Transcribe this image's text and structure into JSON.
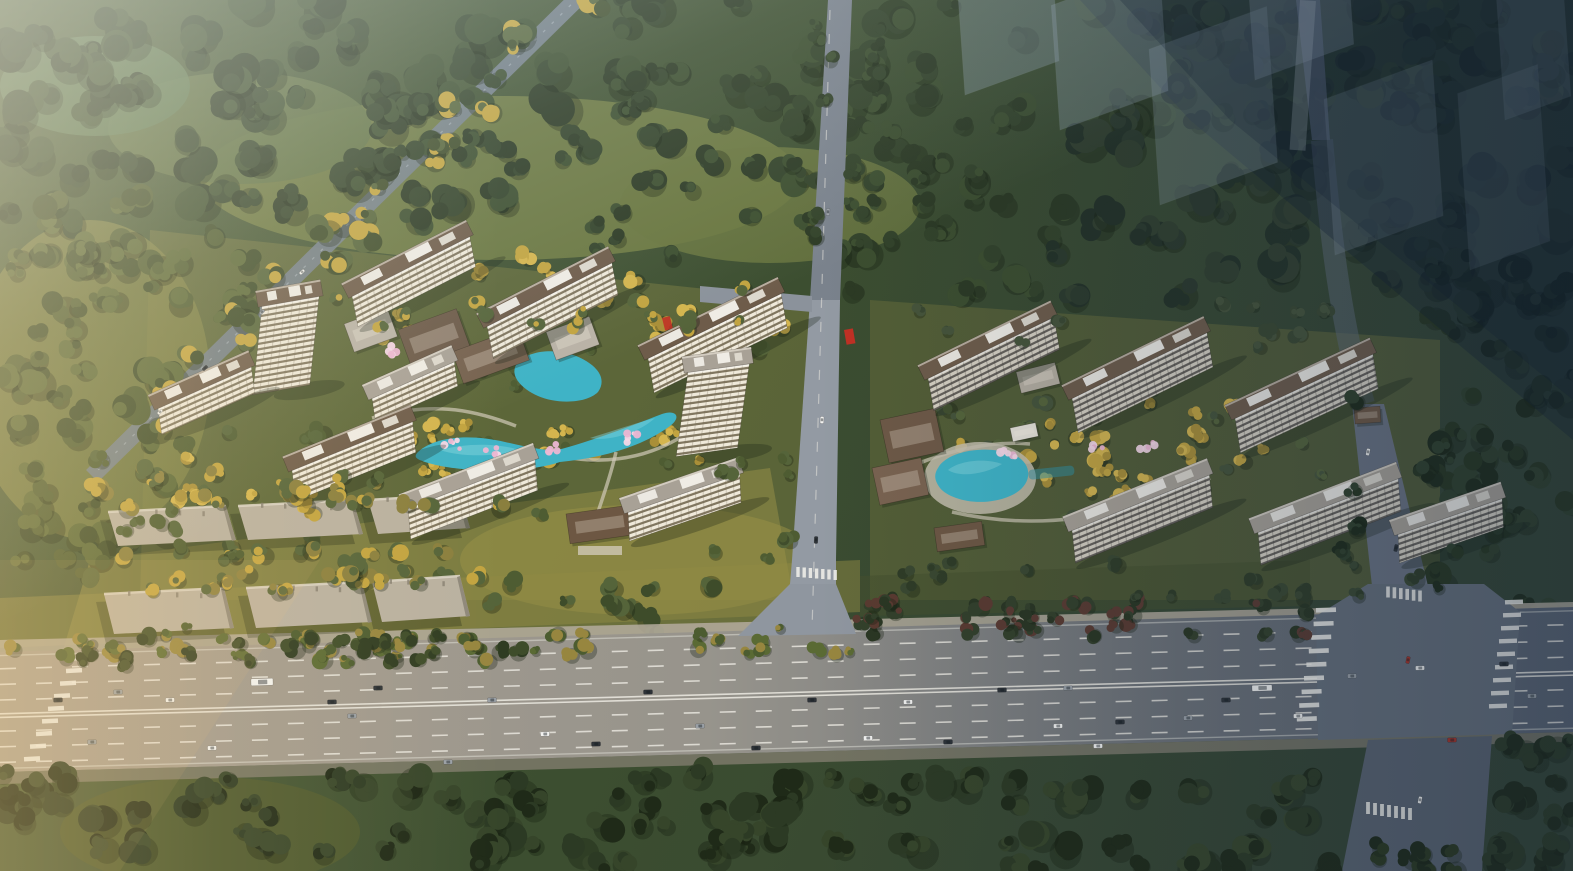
{
  "meta": {
    "title": "Aerial rendering of a residential development masterplan",
    "type": "architectural-rendering",
    "view": "bird's-eye oblique aerial",
    "text_content": "none"
  },
  "scene": {
    "description": "Photorealistic aerial rendering: two residential compounds of high-rise apartment slabs around landscaped courtyards with winding turquoise ponds, cherry-blossom and golden trees, clubhouse pavilions and entrance gates. Dense forest surrounds the site; a tree-lined diagonal road crosses the upper left; a central access road separates the compounds and meets a wide multi-lane arterial highway with traffic along the bottom; an east access road forms a large intersection at lower right. Semi-transparent ghost massing of a future phase fades into the upper right. Warm sunlight enters from the left while the right side falls into blue shadow.",
    "features": [
      "dense forest belts and grass clearings",
      "tree-lined diagonal road (upper left)",
      "future-phase ghost towers (upper right)",
      "west residential compound of apartment slabs",
      "east residential compound of apartment slabs",
      "landscaped courtyards with winding ponds and pool",
      "cherry-blossom and golden ornamental trees",
      "clubhouse pavilions and entrance gates",
      "rows of low-rise buildings (south-west)",
      "central access road with crosswalk",
      "east access road and large intersection",
      "multi-lane arterial highway with vehicles",
      "pedestrian crosswalks",
      "warm sunlight from left, blue shadow to right"
    ],
    "counts": {
      "west_cluster_towers": 10,
      "east_cluster_towers": 6,
      "highway_lanes_approx": 8
    }
  },
  "palette": {
    "sky_haze": "#dfe8ea",
    "sun_warm": "#ffd98f",
    "shadow_blue": "#15273f",
    "forest_dark": "#2c3a24",
    "forest_mid": "#3c4e2f",
    "forest_deep": "#1f2a18",
    "tree_olive": "#55643a",
    "tree_gold": "#c2a440",
    "tree_gold_light": "#d4b54e",
    "tree_maroon": "#5a3a30",
    "grass_olive": "#6f7b42",
    "grass_sunlit": "#9a9148",
    "road_light": "#a39a8e",
    "road_mid": "#939aa3",
    "road_dark": "#5d6571",
    "asphalt_intersection": "#656e79",
    "sidewalk": "#b4ac9e",
    "lane_marking": "#eceae2",
    "water": "#3fb3c6",
    "water_light": "#7fd3dc",
    "water_deep": "#2e93a8",
    "blossom_pink": "#ecb6d2",
    "blossom_light": "#f6d7e6",
    "facade_light": "#efe9da",
    "facade_stripe": "#80765f",
    "facade_dim": "#d7d1c3",
    "facade_stripe_dim": "#66615a",
    "roof_brown": "#6e5c4a",
    "roof_brown_dark": "#57493a",
    "roof_grey": "#a8a196",
    "roof_box_white": "#ece9e2",
    "lowrise_roof": "#b9b1a1",
    "lowrise_edge": "#d9d3c5",
    "lowrise_shade": "#8b8577",
    "clubhouse_brown": "#6b5948",
    "gate_brown": "#6d5743",
    "accent_red": "#c03024",
    "ghost_massing": "#9fb0c2",
    "car_white": "#f2f2f0",
    "car_dark": "#2e3338",
    "car_grey": "#9aa0a6",
    "car_red": "#a83428"
  }
}
